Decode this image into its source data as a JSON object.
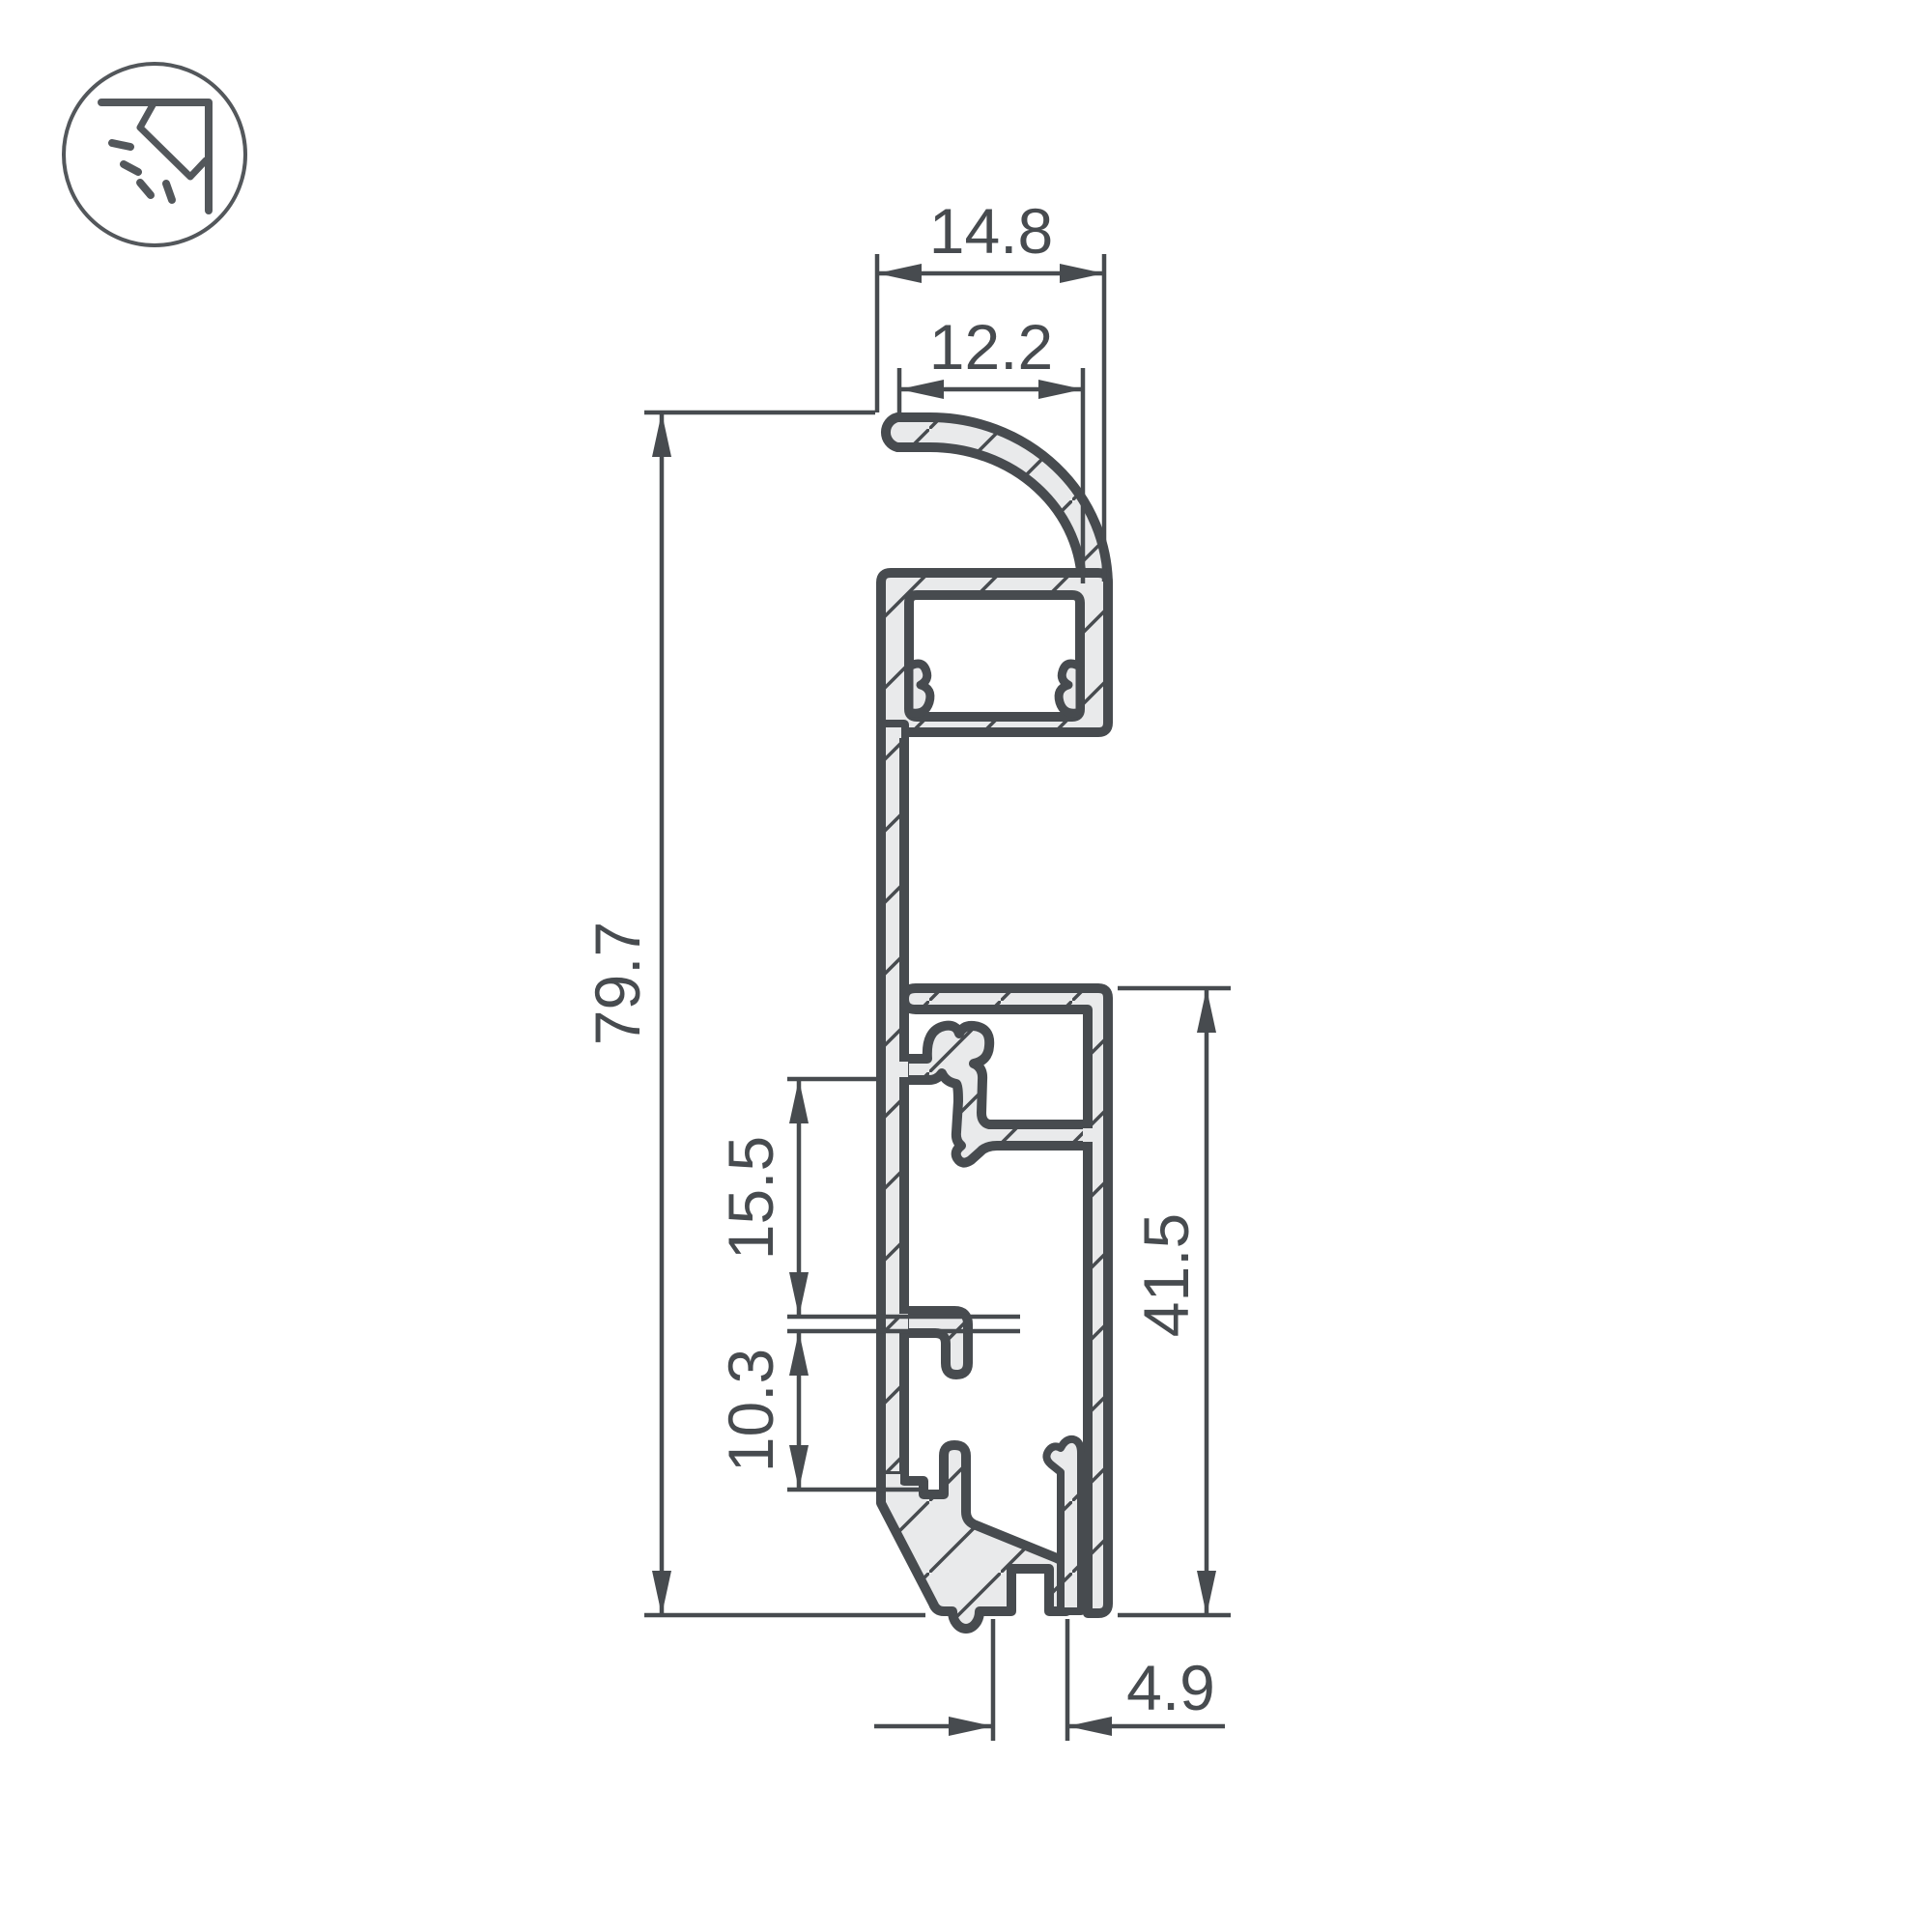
{
  "drawing": {
    "icon": "corner-wall-washer-light-icon",
    "colors": {
      "line": "#474b4f",
      "metal_fill": "#e9eaeb",
      "background": "#ffffff",
      "icon_line": "#53575b"
    },
    "dimensions": {
      "top_width": "14.8",
      "top_opening": "12.2",
      "total_height": "79.7",
      "mid_upper_gap": "15.5",
      "mid_lower_gap": "10.3",
      "lower_box_height": "41.5",
      "bottom_slot": "4.9"
    }
  }
}
